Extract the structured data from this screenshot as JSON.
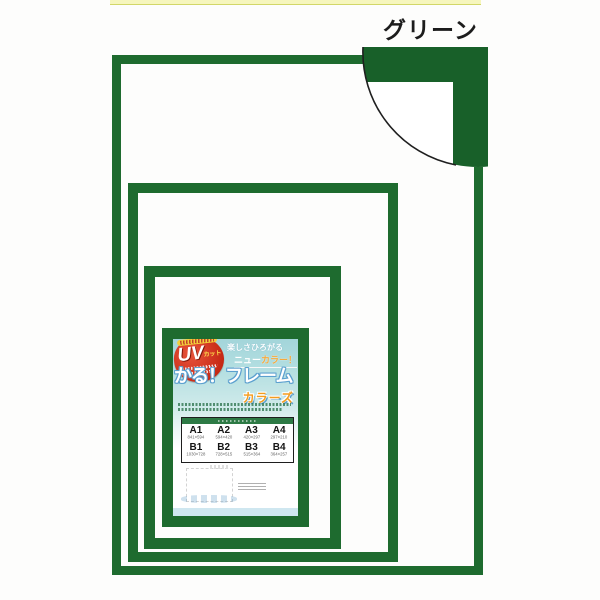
{
  "label_green": "グリーン",
  "poster": {
    "uv_badge": {
      "main": "UV",
      "suffix": "カット"
    },
    "catch1": "楽しさひろがる",
    "catch2_prefix": "ニュー",
    "catch2_colored": "カラー！",
    "title": "かる！フレーム",
    "subtitle": "カラーズ",
    "table": {
      "cells": [
        {
          "label": "A1",
          "size": "841×594"
        },
        {
          "label": "A2",
          "size": "594×420"
        },
        {
          "label": "A3",
          "size": "420×297"
        },
        {
          "label": "A4",
          "size": "297×210"
        },
        {
          "label": "B1",
          "size": "1030×728"
        },
        {
          "label": "B2",
          "size": "728×515"
        },
        {
          "label": "B3",
          "size": "515×364"
        },
        {
          "label": "B4",
          "size": "364×257"
        }
      ]
    }
  },
  "colors": {
    "frame_green": "#1e6b2f",
    "corner_block_green": "#186029",
    "poster_teal": "#aed9de",
    "badge_red": "#c52814",
    "subtitle_orange": "#f39c1f",
    "top_strip_yellow": "#f6f6bd",
    "footer_blue": "#cfe7f0"
  }
}
